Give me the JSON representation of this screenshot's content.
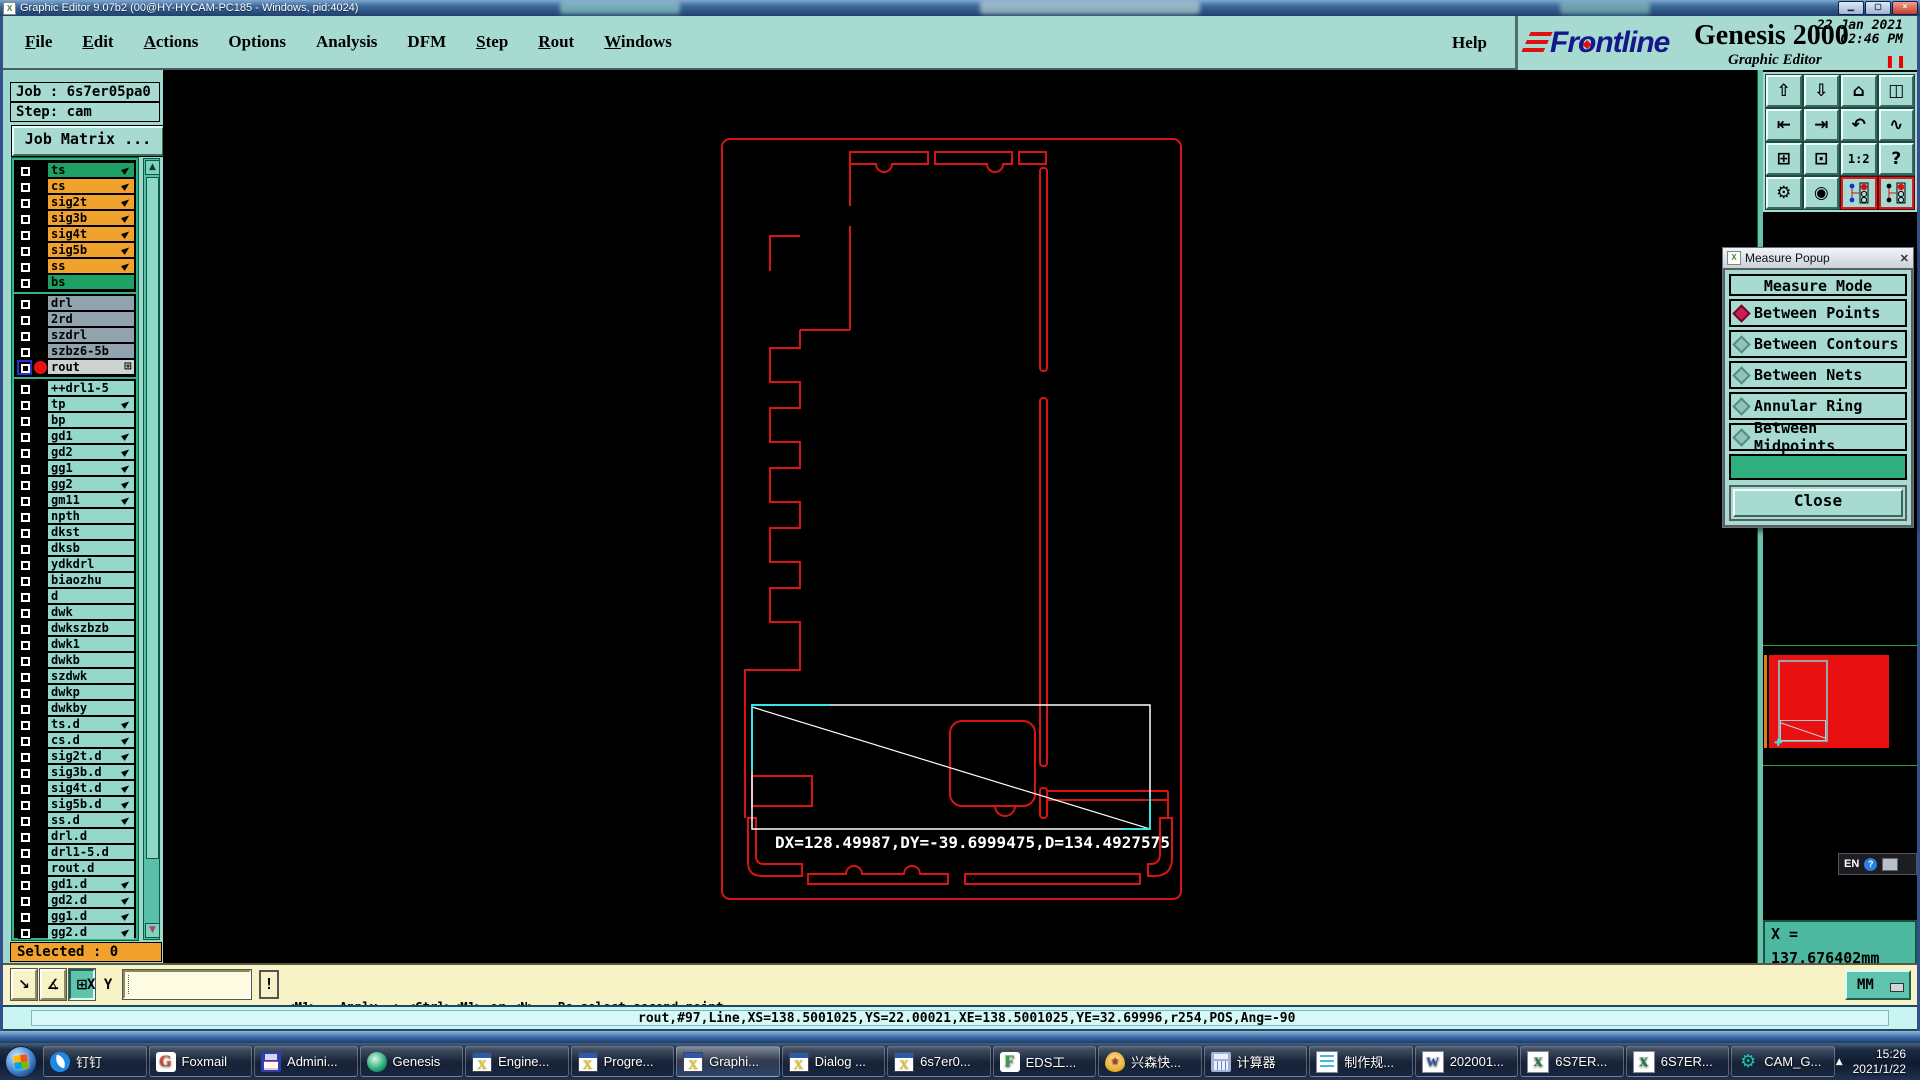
{
  "title_bar": {
    "title": "Graphic Editor 9.07b2 (00@HY-HYCAM-PC185 - Windows, pid:4024)"
  },
  "menu_bar": {
    "items": [
      {
        "label": "File",
        "underline": true
      },
      {
        "label": "Edit",
        "underline": true
      },
      {
        "label": "Actions",
        "underline": true
      },
      {
        "label": "Options",
        "underline": false
      },
      {
        "label": "Analysis",
        "underline": false
      },
      {
        "label": "DFM",
        "underline": false
      },
      {
        "label": "Step",
        "underline": true
      },
      {
        "label": "Rout",
        "underline": true
      },
      {
        "label": "Windows",
        "underline": true
      }
    ],
    "help": "Help"
  },
  "brand": {
    "logo_fr": "Fr",
    "logo_o": "o",
    "logo_rest": "ntline",
    "product": "Genesis 2000",
    "date": "22 Jan 2021",
    "time": "02:46 PM",
    "subtitle": "Graphic Editor"
  },
  "sidebar": {
    "job_label": "Job : 6s7er05pa0",
    "step_label": "Step: cam",
    "matrix_button": "Job Matrix ...",
    "selected_label": "Selected : 0",
    "groups": [
      {
        "rows": [
          {
            "n": "ts",
            "c": "green",
            "p": 1
          },
          {
            "n": "cs",
            "c": "orange",
            "p": 1
          },
          {
            "n": "sig2t",
            "c": "orange",
            "p": 1
          },
          {
            "n": "sig3b",
            "c": "orange",
            "p": 1
          },
          {
            "n": "sig4t",
            "c": "orange",
            "p": 1
          },
          {
            "n": "sig5b",
            "c": "orange",
            "p": 1
          },
          {
            "n": "ss",
            "c": "orange",
            "p": 1
          },
          {
            "n": "bs",
            "c": "green"
          }
        ]
      },
      {
        "rows": [
          {
            "n": "drl",
            "c": "gray"
          },
          {
            "n": "2rd",
            "c": "gray"
          },
          {
            "n": "szdrl",
            "c": "gray"
          },
          {
            "n": "szbz6-5b",
            "c": "gray"
          },
          {
            "n": "rout",
            "c": "silver",
            "sel": 1,
            "grid": 1
          }
        ]
      },
      {
        "rows": [
          {
            "n": "++drl1-5",
            "c": "teal"
          },
          {
            "n": "tp",
            "c": "teal",
            "p": 1
          },
          {
            "n": "bp",
            "c": "teal"
          },
          {
            "n": "gd1",
            "c": "teal",
            "p": 1
          },
          {
            "n": "gd2",
            "c": "teal",
            "p": 1
          },
          {
            "n": "gg1",
            "c": "teal",
            "p": 1
          },
          {
            "n": "gg2",
            "c": "teal",
            "p": 1
          },
          {
            "n": "gm11",
            "c": "teal",
            "p": 1
          },
          {
            "n": "npth",
            "c": "teal"
          },
          {
            "n": "dkst",
            "c": "teal"
          },
          {
            "n": "dksb",
            "c": "teal"
          },
          {
            "n": "ydkdrl",
            "c": "teal"
          },
          {
            "n": "biaozhu",
            "c": "teal"
          },
          {
            "n": "d",
            "c": "teal"
          },
          {
            "n": "dwk",
            "c": "teal"
          },
          {
            "n": "dwkszbzb",
            "c": "teal"
          },
          {
            "n": "dwk1",
            "c": "teal"
          },
          {
            "n": "dwkb",
            "c": "teal"
          },
          {
            "n": "szdwk",
            "c": "teal"
          },
          {
            "n": "dwkp",
            "c": "teal"
          },
          {
            "n": "dwkby",
            "c": "teal"
          },
          {
            "n": "ts.d",
            "c": "teal",
            "p": 1
          },
          {
            "n": "cs.d",
            "c": "teal",
            "p": 1
          },
          {
            "n": "sig2t.d",
            "c": "teal",
            "p": 1
          },
          {
            "n": "sig3b.d",
            "c": "teal",
            "p": 1
          },
          {
            "n": "sig4t.d",
            "c": "teal",
            "p": 1
          },
          {
            "n": "sig5b.d",
            "c": "teal",
            "p": 1
          },
          {
            "n": "ss.d",
            "c": "teal",
            "p": 1
          },
          {
            "n": "drl.d",
            "c": "teal"
          },
          {
            "n": "drl1-5.d",
            "c": "teal"
          },
          {
            "n": "rout.d",
            "c": "teal"
          },
          {
            "n": "gd1.d",
            "c": "teal",
            "p": 1
          },
          {
            "n": "gd2.d",
            "c": "teal",
            "p": 1
          },
          {
            "n": "gg1.d",
            "c": "teal",
            "p": 1
          },
          {
            "n": "gg2.d",
            "c": "teal",
            "p": 1
          }
        ]
      }
    ]
  },
  "right_toolbar": {
    "buttons": [
      {
        "name": "paste-up",
        "glyph": "⇧"
      },
      {
        "name": "paste-down",
        "glyph": "⇩"
      },
      {
        "name": "home-view",
        "glyph": "⌂"
      },
      {
        "name": "tile-windows-xy",
        "glyph": "◫"
      },
      {
        "name": "pan-left",
        "glyph": "⇤"
      },
      {
        "name": "pan-right",
        "glyph": "⇥"
      },
      {
        "name": "undo-view",
        "glyph": "↶"
      },
      {
        "name": "profile-curve",
        "glyph": "∿"
      },
      {
        "name": "zoom-fit",
        "glyph": "⊞"
      },
      {
        "name": "zoom-center",
        "glyph": "⊡"
      },
      {
        "name": "zoom-ratio",
        "glyph": "1:2",
        "small": 1
      },
      {
        "name": "help-query",
        "glyph": "?"
      },
      {
        "name": "setup-tools",
        "glyph": "⚙"
      },
      {
        "name": "inspect-point",
        "glyph": "◉"
      },
      {
        "name": "net-highlight-1",
        "net": 1
      },
      {
        "name": "net-highlight-2",
        "net": 2
      }
    ]
  },
  "measure_popup": {
    "title": "Measure Popup",
    "header": "Measure Mode",
    "options": [
      {
        "label": "Between Points",
        "selected": true
      },
      {
        "label": "Between Contours",
        "selected": false
      },
      {
        "label": "Between Nets",
        "selected": false
      },
      {
        "label": "Annular Ring",
        "selected": false
      },
      {
        "label": "Between Midpoints",
        "selected": false
      }
    ],
    "close_label": "Close"
  },
  "canvas": {
    "measure_text": "DX=128.49987,DY=-39.6999475,D=134.4927575"
  },
  "coords_panel": {
    "x": "X = 137.676402mm",
    "y": "Y = 25.973740mm"
  },
  "units_button": {
    "label": "MM"
  },
  "language_bar": {
    "label": "EN",
    "help": "?"
  },
  "bottom_bar": {
    "xy_label": "X Y :",
    "input_value": "",
    "alert_label": "!",
    "prompt_line1": "<M1> - Apply  ; <Ctrl><M1> or <N> - Re-select second point",
    "prompt_line2": "<M2> - Cancel ; <Shift><M1> or <Shift><N> - Re-select first point"
  },
  "status_bar": {
    "text": "rout,#97,Line,XS=138.5001025,YS=22.00021,XE=138.5001025,YE=32.69996,r254,POS,Ang=-90"
  },
  "taskbar": {
    "items": [
      {
        "label": "钉钉",
        "icon": "dingtalk"
      },
      {
        "label": "Foxmail",
        "icon": "foxmail",
        "letter": "G"
      },
      {
        "label": "Admini...",
        "icon": "floppy"
      },
      {
        "label": "Genesis",
        "icon": "genesis"
      },
      {
        "label": "Engine...",
        "icon": "xwin"
      },
      {
        "label": "Progre...",
        "icon": "xwin"
      },
      {
        "label": "Graphi...",
        "icon": "xwin",
        "active": true
      },
      {
        "label": "Dialog ...",
        "icon": "xwin"
      },
      {
        "label": "6s7er0...",
        "icon": "xwin"
      },
      {
        "label": "EDS工...",
        "icon": "eds",
        "letter": "F"
      },
      {
        "label": "兴森快...",
        "icon": "shell",
        "letter": "★"
      },
      {
        "label": "计算器",
        "icon": "calc"
      },
      {
        "label": "制作规...",
        "icon": "doc"
      },
      {
        "label": "202001...",
        "icon": "word",
        "letter": "W"
      },
      {
        "label": "6S7ER...",
        "icon": "excel",
        "letter": "X"
      },
      {
        "label": "6S7ER...",
        "icon": "excel",
        "letter": "X"
      },
      {
        "label": "CAM_G...",
        "icon": "gear",
        "letter": "⚙"
      }
    ],
    "clock_time": "15:26",
    "clock_date": "2021/1/22"
  }
}
